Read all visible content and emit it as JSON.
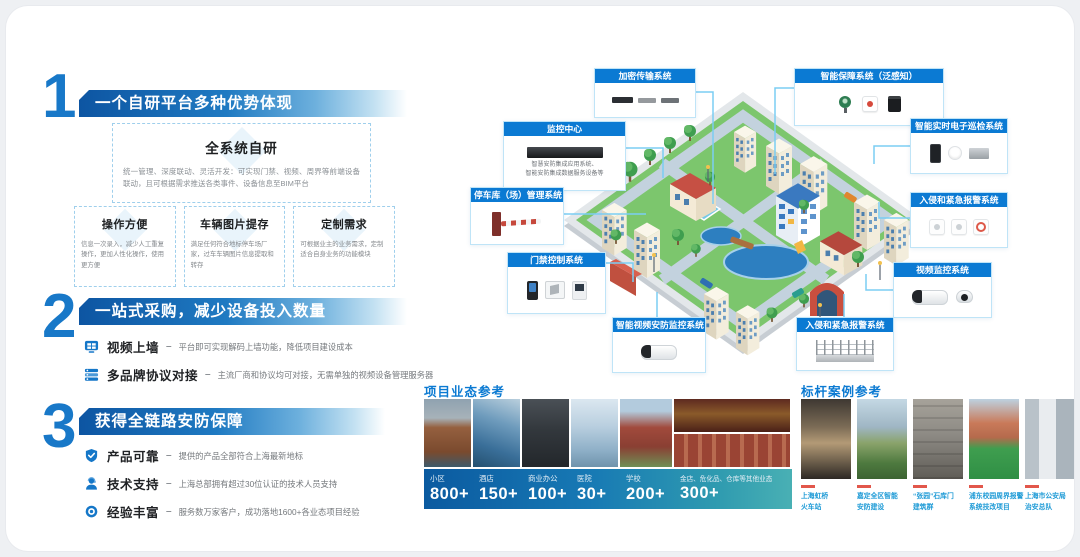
{
  "ui": {
    "sep": "–"
  },
  "colors": {
    "accent": "#1577c8",
    "callout_header": "#0b7ad3",
    "line": "#7bcdf3",
    "dash_red": "#e2574b",
    "case_label": "#1d9ad6"
  },
  "sections": [
    {
      "number": "1",
      "title": "一个自研平台多种优势体现",
      "panel": {
        "title": "全系统自研",
        "desc": "统一管理、深度联动、灵活开发：可实现门禁、视频、周界等前端设备联动，且可根据需求推送各类事件、设备信息至BIM平台"
      },
      "cards": [
        {
          "title": "操作方便",
          "desc": "信息一次录入，减少人工重复操作，更加人性化操作，使用更方便"
        },
        {
          "title": "车辆图片提存",
          "desc": "满足任何符合地标停车场厂家，过车车辆图片信息提取和转存"
        },
        {
          "title": "定制需求",
          "desc": "可根据业主的业务需求，定制适合自身业务的功能模块"
        }
      ]
    },
    {
      "number": "2",
      "title": "一站式采购，减少设备投入数量",
      "bullets": [
        {
          "icon": "video-wall-icon",
          "label": "视频上墙",
          "desc": "平台即可实现解码上墙功能，降低项目建设成本"
        },
        {
          "icon": "multi-brand-icon",
          "label": "多品牌协议对接",
          "desc": "主流厂商和协议均可对接，无需单独的视频设备管理服务器"
        }
      ]
    },
    {
      "number": "3",
      "title": "获得全链路安防保障",
      "bullets": [
        {
          "icon": "shield-check-icon",
          "label": "产品可靠",
          "desc": "提供的产品全部符合上海最新地标"
        },
        {
          "icon": "support-agent-icon",
          "label": "技术支持",
          "desc": "上海总部拥有超过30位认证的技术人员支持"
        },
        {
          "icon": "target-icon",
          "label": "经验丰富",
          "desc": "服务数万家客户，成功落地1600+各业态项目经验"
        }
      ]
    }
  ],
  "diagram": {
    "labels": {
      "encrypt": {
        "title": "加密传输系统"
      },
      "perception": {
        "title": "智能保障系统（泛感知）"
      },
      "monitor_center": {
        "title": "监控中心",
        "desc1": "智慧安防集成应用系统、",
        "desc2": "智能安防集成数据服务设备等"
      },
      "parking": {
        "title": "停车库（场）管理系统"
      },
      "access": {
        "title": "门禁控制系统"
      },
      "smart_video": {
        "title": "智能视频安防监控系统"
      },
      "patrol": {
        "title": "智能实时电子巡检系统"
      },
      "intrusion_right": {
        "title": "入侵和紧急报警系统"
      },
      "video_monitor": {
        "title": "视频监控系统"
      },
      "intrusion_bottom": {
        "title": "入侵和紧急报警系统"
      }
    }
  },
  "projects": {
    "title": "项目业态参考",
    "stats": [
      {
        "label": "小区",
        "count": "800+"
      },
      {
        "label": "酒店",
        "count": "150+"
      },
      {
        "label": "商业办公",
        "count": "100+"
      },
      {
        "label": "医院",
        "count": "30+"
      },
      {
        "label": "学校",
        "count": "200+"
      },
      {
        "label": "金店、危化品、仓库等其他业态",
        "count": "300+"
      }
    ]
  },
  "cases": {
    "title": "标杆案例参考",
    "items": [
      {
        "line1": "上海虹桥",
        "line2": "火车站"
      },
      {
        "line1": "嘉定全区智能",
        "line2": "安防建设"
      },
      {
        "line1": "“张园”石库门",
        "line2": "建筑群"
      },
      {
        "line1": "浦东校园周界报警",
        "line2": "系统技改项目"
      },
      {
        "line1": "上海市公安局",
        "line2": "治安总队"
      }
    ]
  }
}
